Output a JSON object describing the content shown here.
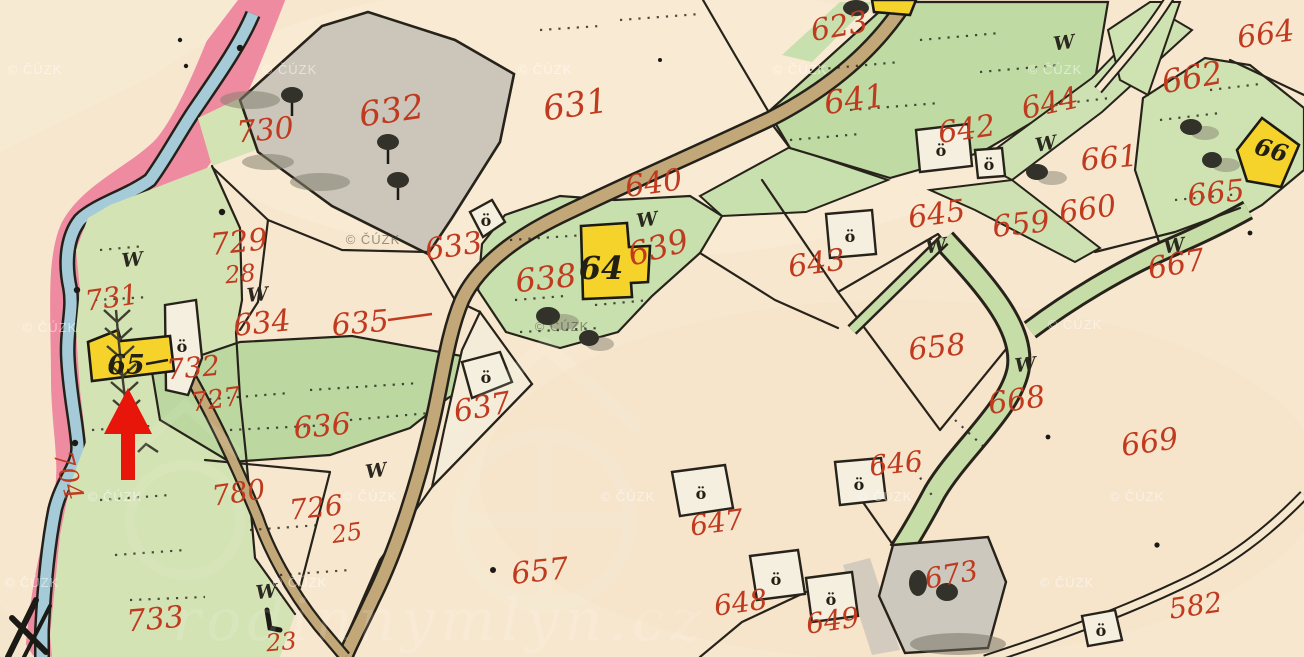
{
  "map": {
    "description": "Historical hand-drawn cadastral map sheet with red parcel numbers, yellow and white buildings, meadows, roads and a stream; a red arrow marks building 65",
    "arrow": {
      "points_to": "65"
    }
  },
  "watermark": {
    "copyright": "© ČÚZK",
    "site": "rodinnymlyn.cz"
  },
  "symbols": {
    "meadow": "W",
    "building_mark": "ö"
  },
  "building_numbers": {
    "b64": "64",
    "b65": "65",
    "b66": "66"
  },
  "parcel_numbers": {
    "p730": "730",
    "p632": "632",
    "p631": "631",
    "p623": "623",
    "p641": "641",
    "p664": "664",
    "p662": "662",
    "p644": "644",
    "p642": "642",
    "p661": "661",
    "p645": "645",
    "p659": "659",
    "p660": "660",
    "p665": "665",
    "p667": "667",
    "p729": "729",
    "p28": "28",
    "p633": "633",
    "p640": "640",
    "p638": "638",
    "p639": "639",
    "p643": "643",
    "p731": "731",
    "p634": "634",
    "p635": "635",
    "p658": "658",
    "p732": "732",
    "p727": "727",
    "p668": "668",
    "p637": "637",
    "p669": "669",
    "p636": "636",
    "p780": "780",
    "p726": "726",
    "p25": "25",
    "p646": "646",
    "p647": "647",
    "p657": "657",
    "p648": "648",
    "p649": "649",
    "p673": "673",
    "p582": "582",
    "p23": "23",
    "p733": "733",
    "p704": "704"
  },
  "colors": {
    "paper": "#f7e7cf",
    "pink_border": "#ef8ba0",
    "water": "#a6cbd8",
    "meadow_light": "#d4e3b4",
    "meadow": "#bcd8a0",
    "road": "#c2a878",
    "building_yellow": "#f6d32b",
    "built_gray": "#cbc5ba",
    "label_red": "#bf3a1e",
    "ink": "#221f15",
    "arrow_red": "#e8150b"
  }
}
